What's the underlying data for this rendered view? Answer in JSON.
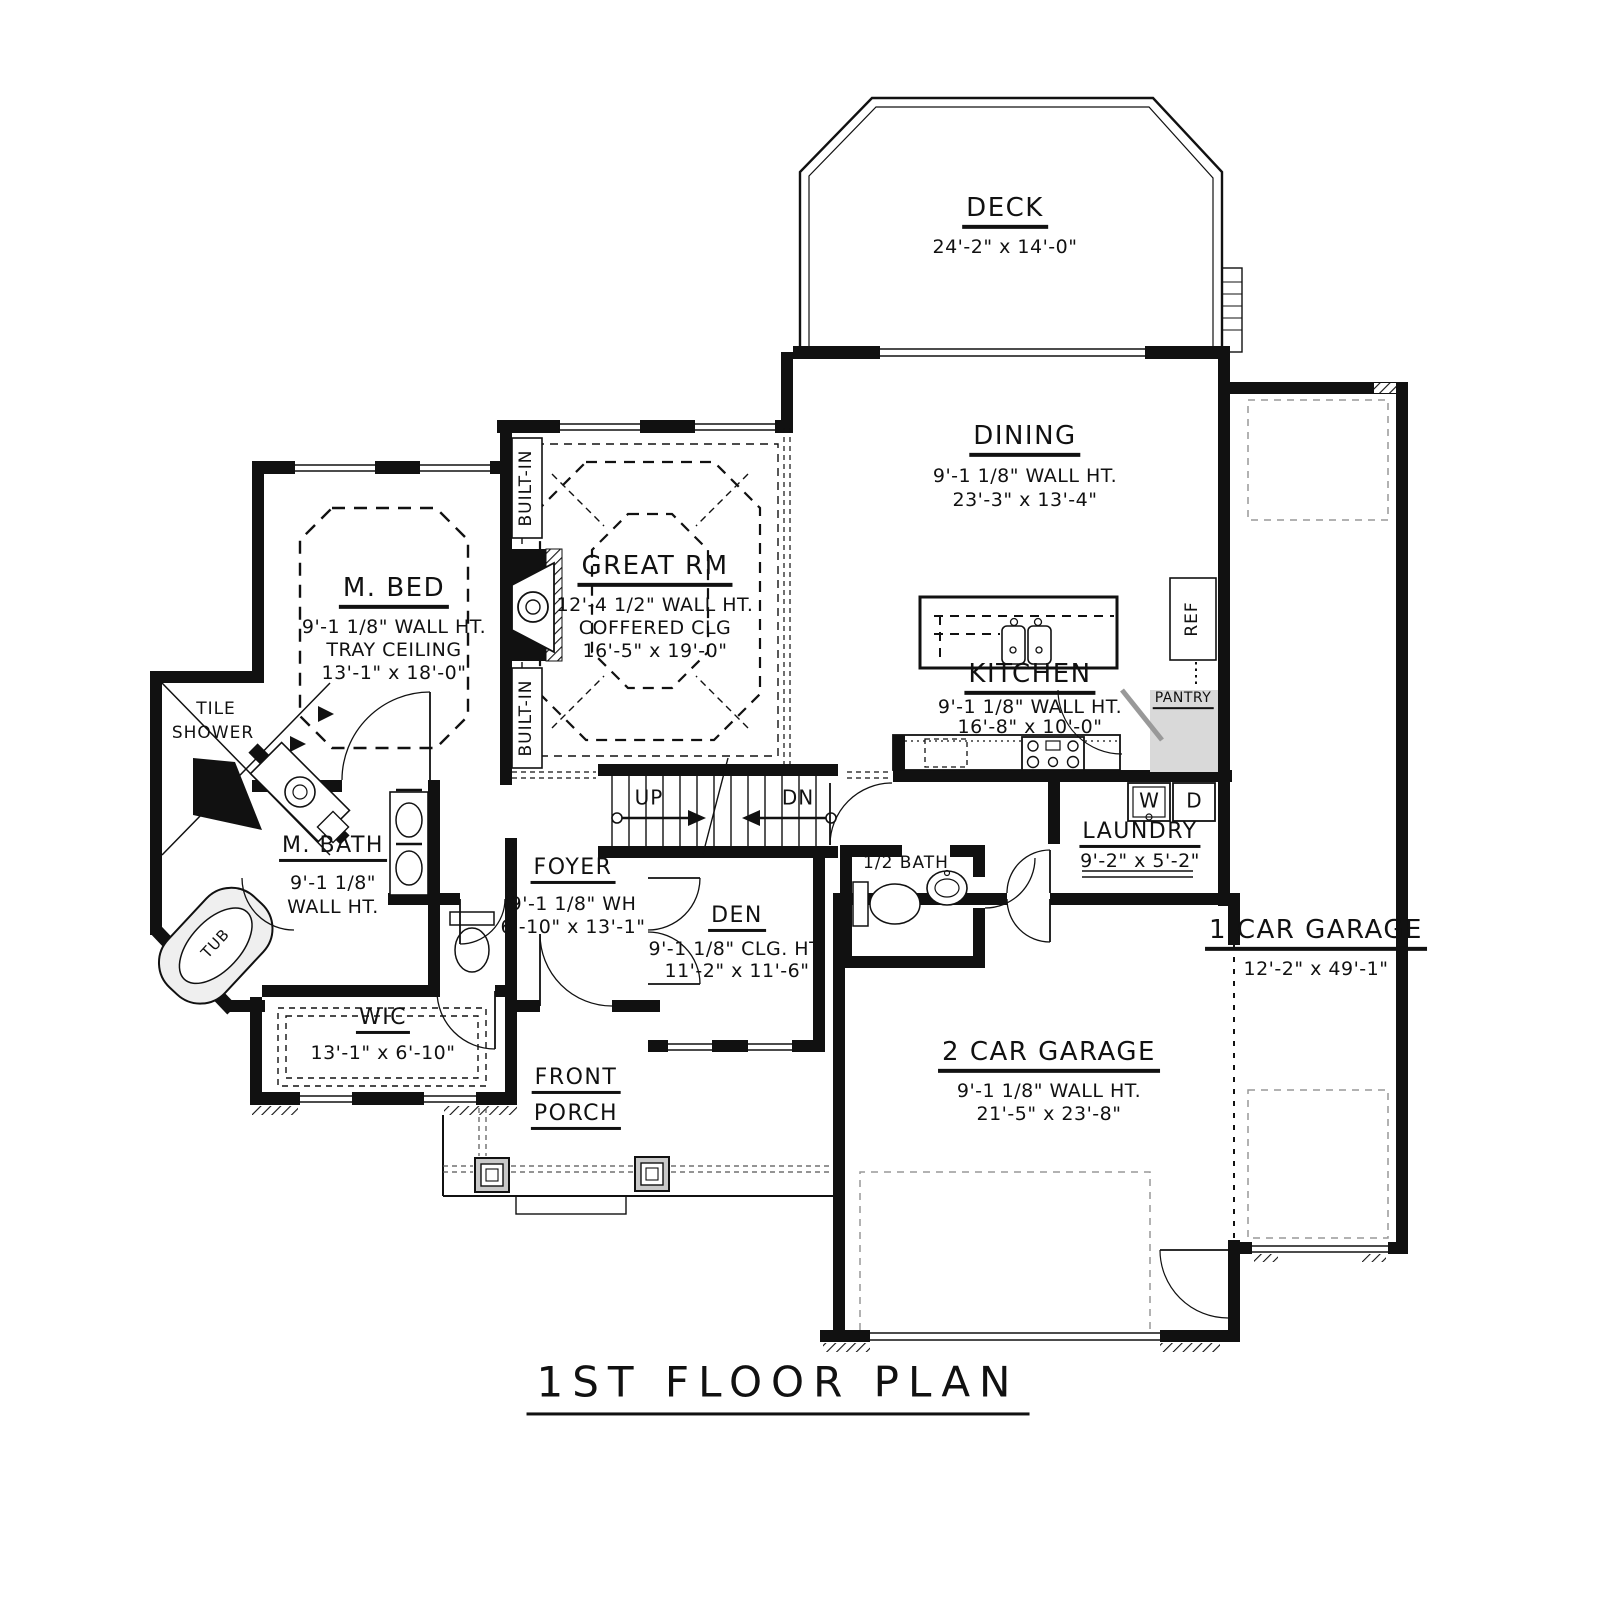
{
  "title": "1ST FLOOR PLAN",
  "rooms": {
    "deck": {
      "name": "DECK",
      "dims": "24'-2\" x 14'-0\""
    },
    "dining": {
      "name": "DINING",
      "wall": "9'-1 1/8\" WALL HT.",
      "dims": "23'-3\" x 13'-4\""
    },
    "great_rm": {
      "name": "GREAT RM",
      "wall": "12'-4 1/2\" WALL HT.",
      "clg": "COFFERED CLG",
      "dims": "16'-5\" x 19'-0\""
    },
    "m_bed": {
      "name": "M. BED",
      "wall": "9'-1 1/8\" WALL HT.",
      "clg": "TRAY CEILING",
      "dims": "13'-1\" x 18'-0\""
    },
    "kitchen": {
      "name": "KITCHEN",
      "wall": "9'-1 1/8\" WALL HT.",
      "dims": "16'-8\" x 10'-0\""
    },
    "m_bath": {
      "name": "M. BATH",
      "wall1": "9'-1 1/8\"",
      "wall2": "WALL HT."
    },
    "tile_shower": {
      "l1": "TILE",
      "l2": "SHOWER"
    },
    "tub": {
      "name": "TUB"
    },
    "wic": {
      "name": "WIC",
      "dims": "13'-1\" x 6'-10\""
    },
    "foyer": {
      "name": "FOYER",
      "wall": "9'-1 1/8\" WH",
      "dims": "6'-10\" x 13'-1\""
    },
    "den": {
      "name": "DEN",
      "wall": "9'-1 1/8\" CLG. HT.",
      "dims": "11'-2\" x 11'-6\""
    },
    "laundry": {
      "name": "LAUNDRY",
      "dims": "9'-2\" x 5'-2\""
    },
    "half_bath": {
      "name": "1/2 BATH"
    },
    "pantry": {
      "name": "PANTRY"
    },
    "ref": {
      "name": "REF"
    },
    "washer": {
      "name": "W"
    },
    "dryer": {
      "name": "D"
    },
    "garage2": {
      "name": "2 CAR GARAGE",
      "wall": "9'-1 1/8\" WALL HT.",
      "dims": "21'-5\" x 23'-8\""
    },
    "garage1": {
      "name": "1 CAR GARAGE",
      "dims": "12'-2\" x 49'-1\""
    },
    "porch": {
      "l1": "FRONT",
      "l2": "PORCH"
    },
    "built_in_top": {
      "name": "BUILT-IN"
    },
    "built_in_bottom": {
      "name": "BUILT-IN"
    },
    "stairs": {
      "up": "UP",
      "dn": "DN"
    }
  },
  "colors": {
    "line": "#111111",
    "gray": "#999999",
    "fill_gray": "#d9d9d9"
  }
}
